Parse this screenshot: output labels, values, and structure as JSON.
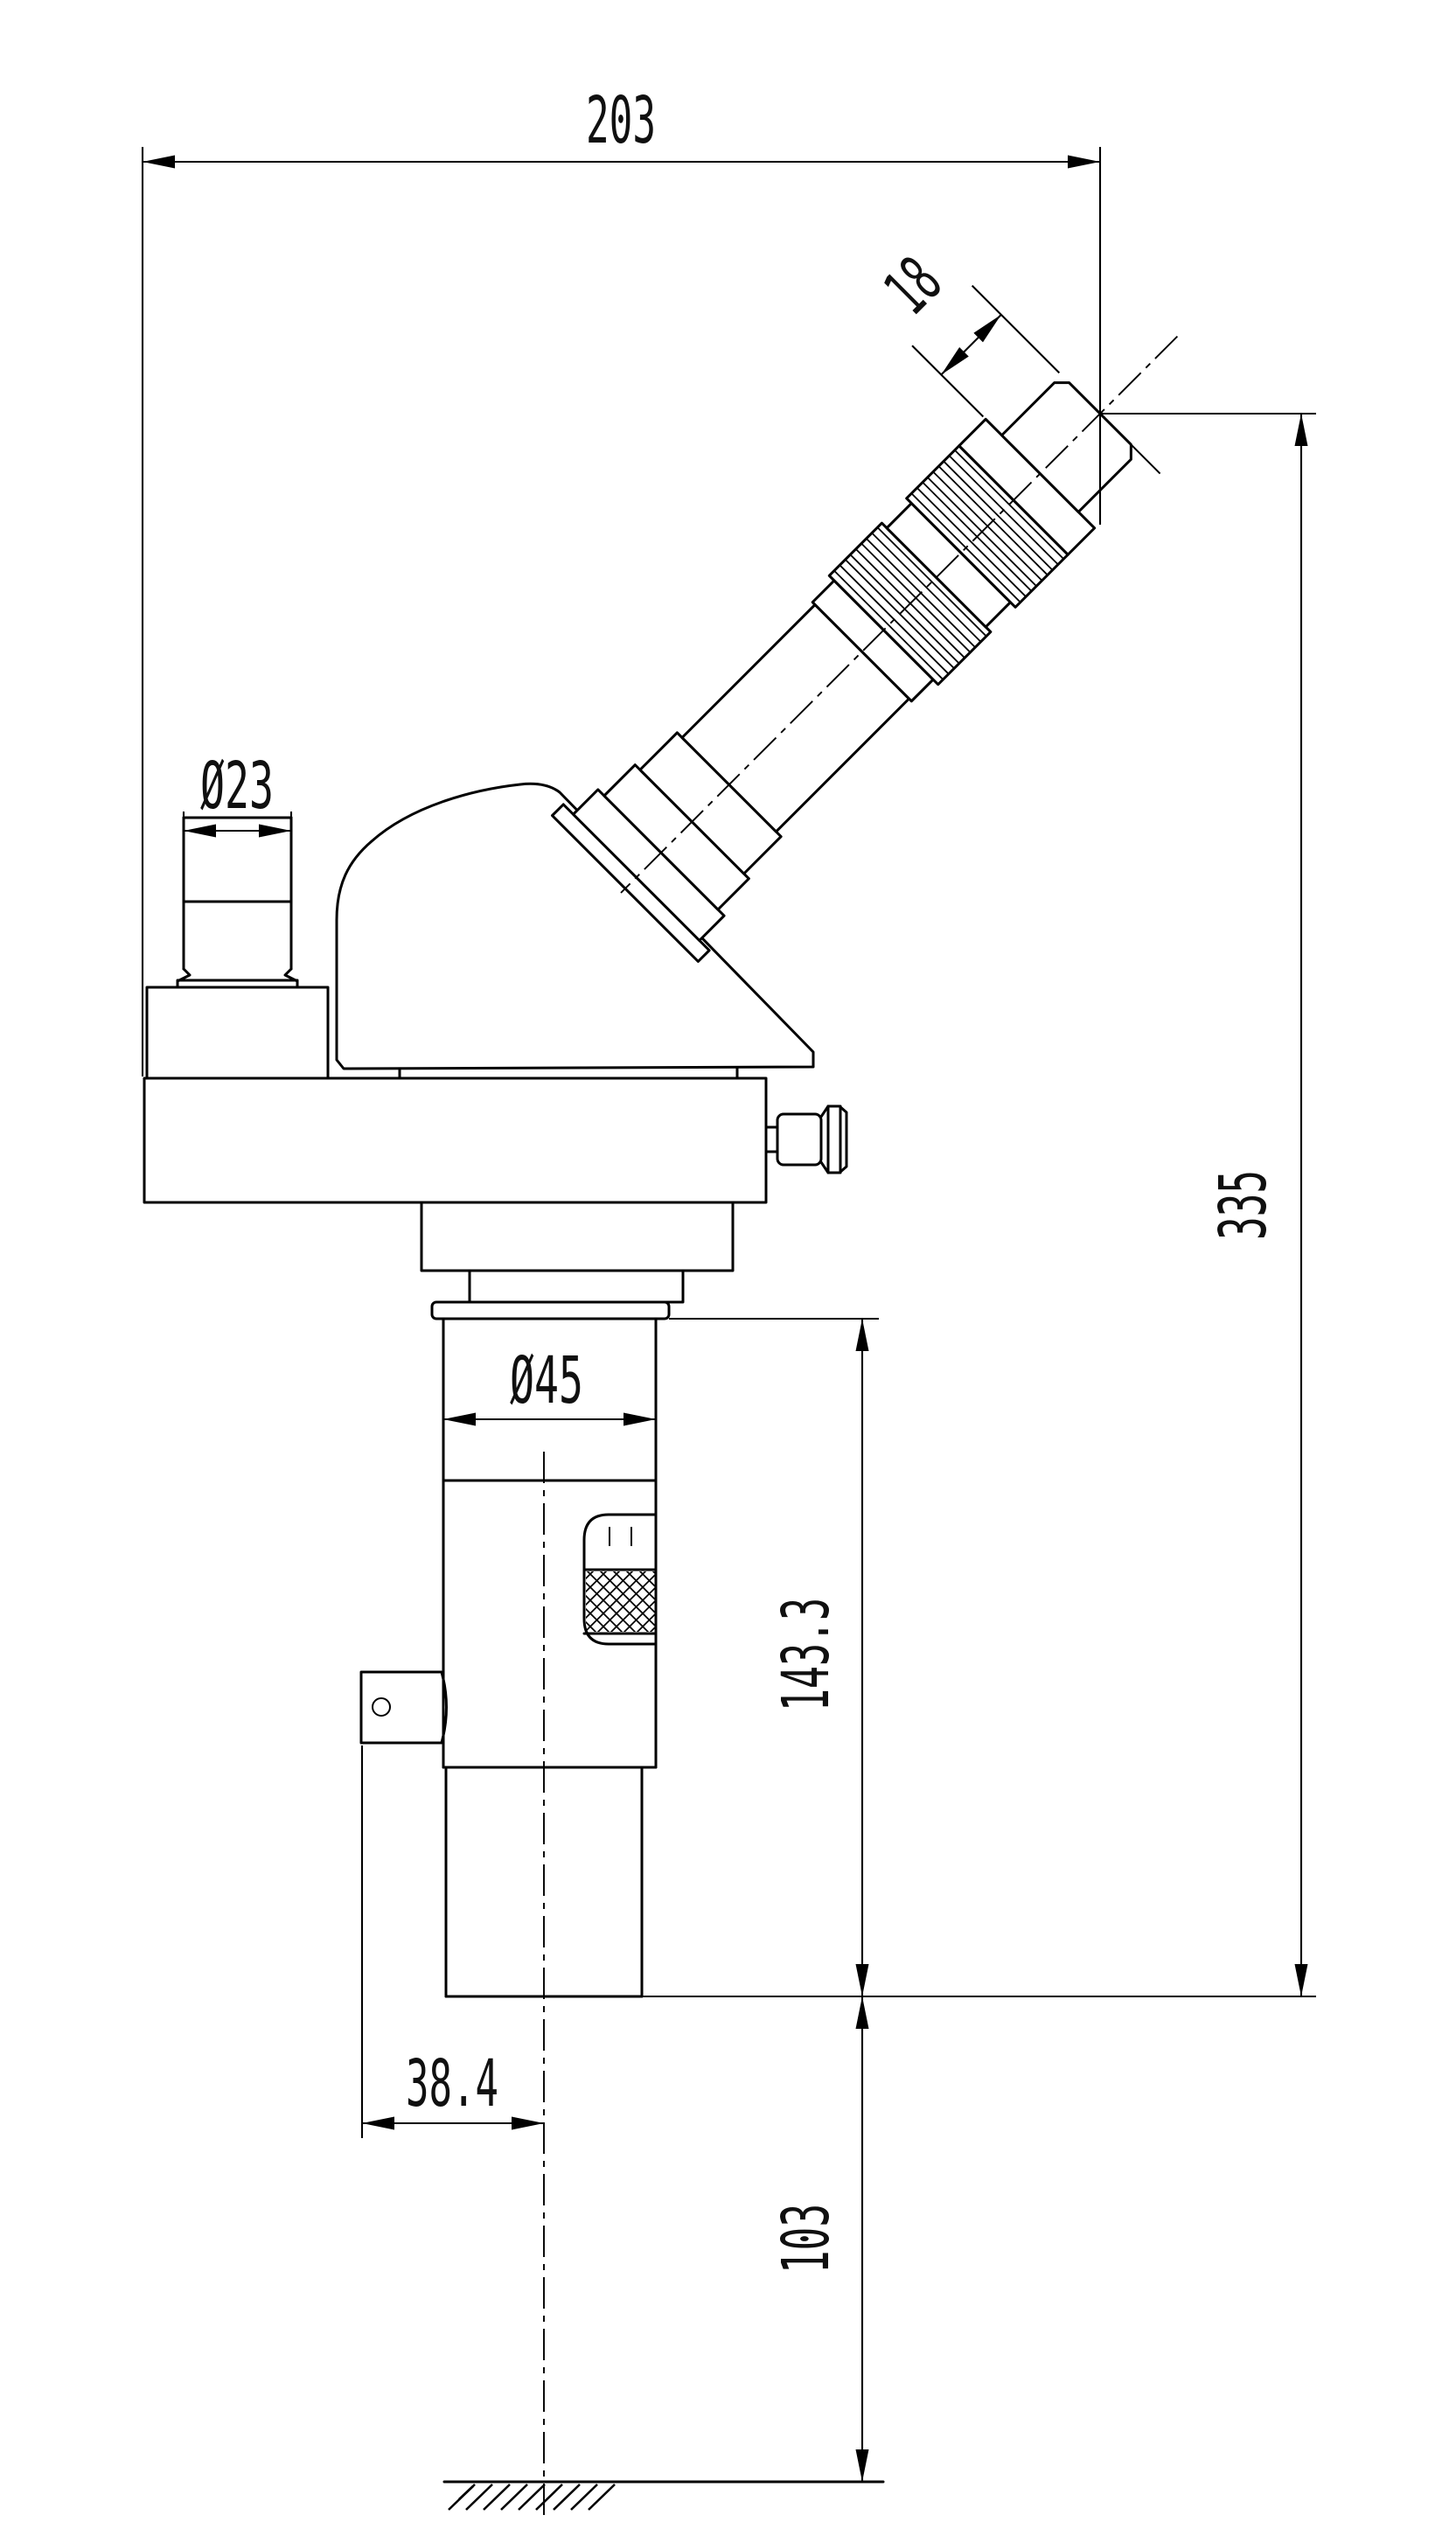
{
  "drawing": {
    "type": "engineering-dimension-drawing",
    "subject": "microscope-head-side-view",
    "colors": {
      "line": "#000000",
      "background": "#ffffff"
    },
    "dimensions": {
      "overall_width": {
        "label": "203"
      },
      "eyepiece_end": {
        "label": "18"
      },
      "photo_port_diameter": {
        "label": "Ø23"
      },
      "mount_tube_diameter": {
        "label": "Ø45"
      },
      "overall_height": {
        "label": "335"
      },
      "tube_length": {
        "label": "143.3"
      },
      "axis_offset": {
        "label": "38.4"
      },
      "clearance_height": {
        "label": "103"
      }
    }
  }
}
